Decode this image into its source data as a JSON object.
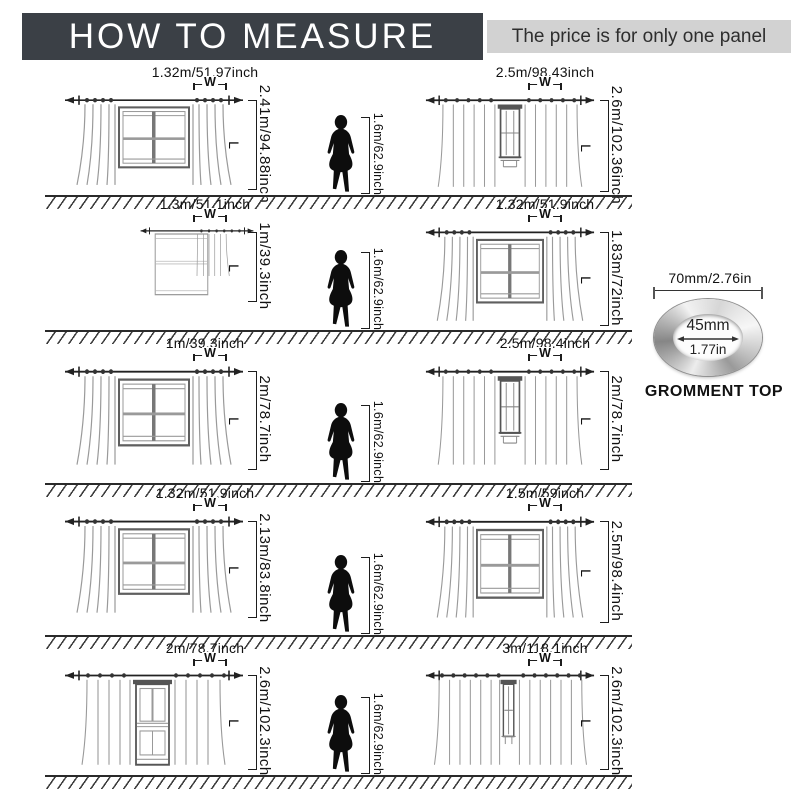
{
  "header": {
    "title": "HOW TO MEASURE",
    "subtitle": "The price is for only one panel"
  },
  "labels": {
    "w": "W",
    "l": "L",
    "person_height": "1.6m/62.9inch"
  },
  "grommet": {
    "outer_diameter": "70mm/2.76in",
    "inner_diameter_mm": "45mm",
    "inner_diameter_in": "1.77in",
    "caption": "GROMMENT TOP"
  },
  "rows": [
    {
      "left": {
        "width": "1.32m/51.97inch",
        "length": "2.41m/94.88inch"
      },
      "right": {
        "width": "2.5m/98.43inch",
        "length": "2.6m/102.36inch"
      }
    },
    {
      "left": {
        "width": "1.3m/51.1inch",
        "length": "1m/39.3inch"
      },
      "right": {
        "width": "1.32m/51.9inch",
        "length": "1.83m/72inch"
      }
    },
    {
      "left": {
        "width": "1m/39.3inch",
        "length": "2m/78.7inch"
      },
      "right": {
        "width": "2.5m/98.4inch",
        "length": "2m/78.7inch"
      }
    },
    {
      "left": {
        "width": "1.32m/51.9inch",
        "length": "2.13m/83.8inch"
      },
      "right": {
        "width": "1.5m/59inch",
        "length": "2.5m/98.4inch"
      }
    },
    {
      "left": {
        "width": "2m/78.7inch",
        "length": "2.6m/102.3inch"
      },
      "right": {
        "width": "3m/118.1inch",
        "length": "2.6m/102.3inch"
      }
    }
  ]
}
